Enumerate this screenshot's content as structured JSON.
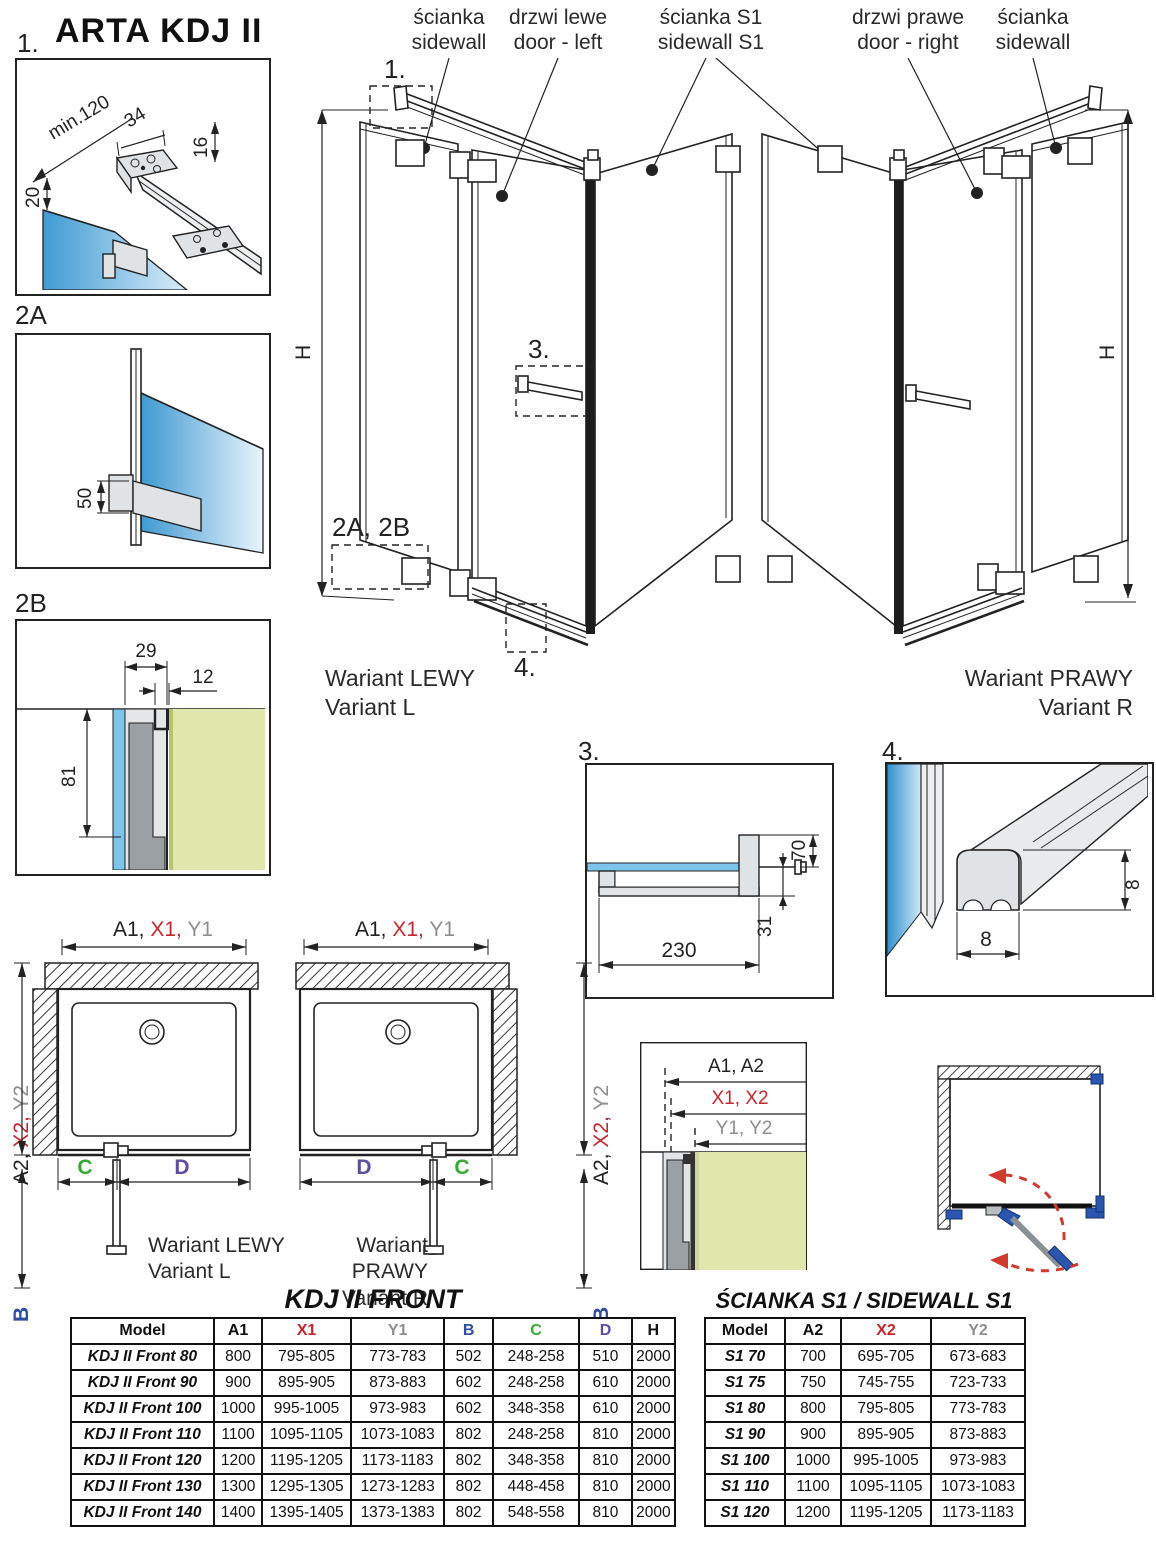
{
  "title": "ARTA KDJ II",
  "colors": {
    "accent_red": "#c1272d",
    "dim_gray": "#8e8e8e",
    "b_blue": "#2e4d9e",
    "c_green": "#39a935",
    "d_purple": "#5c4ea0",
    "glass_blue": "#3f9ad2",
    "wall_green": "#dfe7ac",
    "hinge_blue": "#2a56b0",
    "arc_red": "#d03a2f"
  },
  "callouts": {
    "c1": "1.",
    "c2a": "2A",
    "c2b": "2B",
    "c2ab": "2A, 2B",
    "c3": "3.",
    "c4": "4."
  },
  "details": {
    "d1": {
      "min120": "min.120",
      "d34": "34",
      "d16": "16",
      "d20": "20"
    },
    "d2a": {
      "d50": "50"
    },
    "d2b": {
      "d29": "29",
      "d12": "12",
      "d81": "81"
    },
    "d3": {
      "d70": "70",
      "d31": "31",
      "d230": "230"
    },
    "d4": {
      "d8v": "8",
      "d8h": "8"
    }
  },
  "iso": {
    "h": "H",
    "labels": [
      {
        "line1": "ścianka",
        "line2": "sidewall"
      },
      {
        "line1": "drzwi lewe",
        "line2": "door - left"
      },
      {
        "line1": "ścianka S1",
        "line2": "sidewall S1"
      },
      {
        "line1": "drzwi prawe",
        "line2": "door - right"
      },
      {
        "line1": "ścianka",
        "line2": "sidewall"
      }
    ],
    "variant_l": {
      "line1": "Wariant LEWY",
      "line2": "Variant L"
    },
    "variant_r": {
      "line1": "Wariant PRAWY",
      "line2": "Variant R"
    }
  },
  "plans": {
    "top_a": "A1,",
    "top_x": "X1,",
    "top_y": "Y1",
    "side_a": "A2,",
    "side_x": "X2,",
    "side_y": "Y2",
    "b": "B",
    "c": "C",
    "d": "D",
    "variant_l": {
      "line1": "Wariant LEWY",
      "line2": "Variant L"
    },
    "variant_r": {
      "line1": "Wariant PRAWY",
      "line2": "Variant R"
    }
  },
  "ref_detail": {
    "line_a": "A1, A2",
    "line_x": "X1, X2",
    "line_y": "Y1, Y2"
  },
  "front_table": {
    "title": "KDJ II FRONT",
    "headers": [
      "Model",
      "A1",
      "X1",
      "Y1",
      "B",
      "C",
      "D",
      "H"
    ],
    "header_colors": [
      "#111",
      "#111",
      "#c1272d",
      "#8e8e8e",
      "#2e4d9e",
      "#39a935",
      "#5c4ea0",
      "#111"
    ],
    "rows": [
      [
        "KDJ II Front 80",
        "800",
        "795-805",
        "773-783",
        "502",
        "248-258",
        "510",
        "2000"
      ],
      [
        "KDJ II Front 90",
        "900",
        "895-905",
        "873-883",
        "602",
        "248-258",
        "610",
        "2000"
      ],
      [
        "KDJ II Front 100",
        "1000",
        "995-1005",
        "973-983",
        "602",
        "348-358",
        "610",
        "2000"
      ],
      [
        "KDJ II Front 110",
        "1100",
        "1095-1105",
        "1073-1083",
        "802",
        "248-258",
        "810",
        "2000"
      ],
      [
        "KDJ II Front 120",
        "1200",
        "1195-1205",
        "1173-1183",
        "802",
        "348-358",
        "810",
        "2000"
      ],
      [
        "KDJ II Front 130",
        "1300",
        "1295-1305",
        "1273-1283",
        "802",
        "448-458",
        "810",
        "2000"
      ],
      [
        "KDJ II Front 140",
        "1400",
        "1395-1405",
        "1373-1383",
        "802",
        "548-558",
        "810",
        "2000"
      ]
    ]
  },
  "s1_table": {
    "title": "ŚCIANKA S1 / SIDEWALL S1",
    "headers": [
      "Model",
      "A2",
      "X2",
      "Y2"
    ],
    "header_colors": [
      "#111",
      "#111",
      "#c1272d",
      "#8e8e8e"
    ],
    "rows": [
      [
        "S1 70",
        "700",
        "695-705",
        "673-683"
      ],
      [
        "S1 75",
        "750",
        "745-755",
        "723-733"
      ],
      [
        "S1 80",
        "800",
        "795-805",
        "773-783"
      ],
      [
        "S1 90",
        "900",
        "895-905",
        "873-883"
      ],
      [
        "S1 100",
        "1000",
        "995-1005",
        "973-983"
      ],
      [
        "S1 110",
        "1100",
        "1095-1105",
        "1073-1083"
      ],
      [
        "S1 120",
        "1200",
        "1195-1205",
        "1173-1183"
      ]
    ]
  }
}
